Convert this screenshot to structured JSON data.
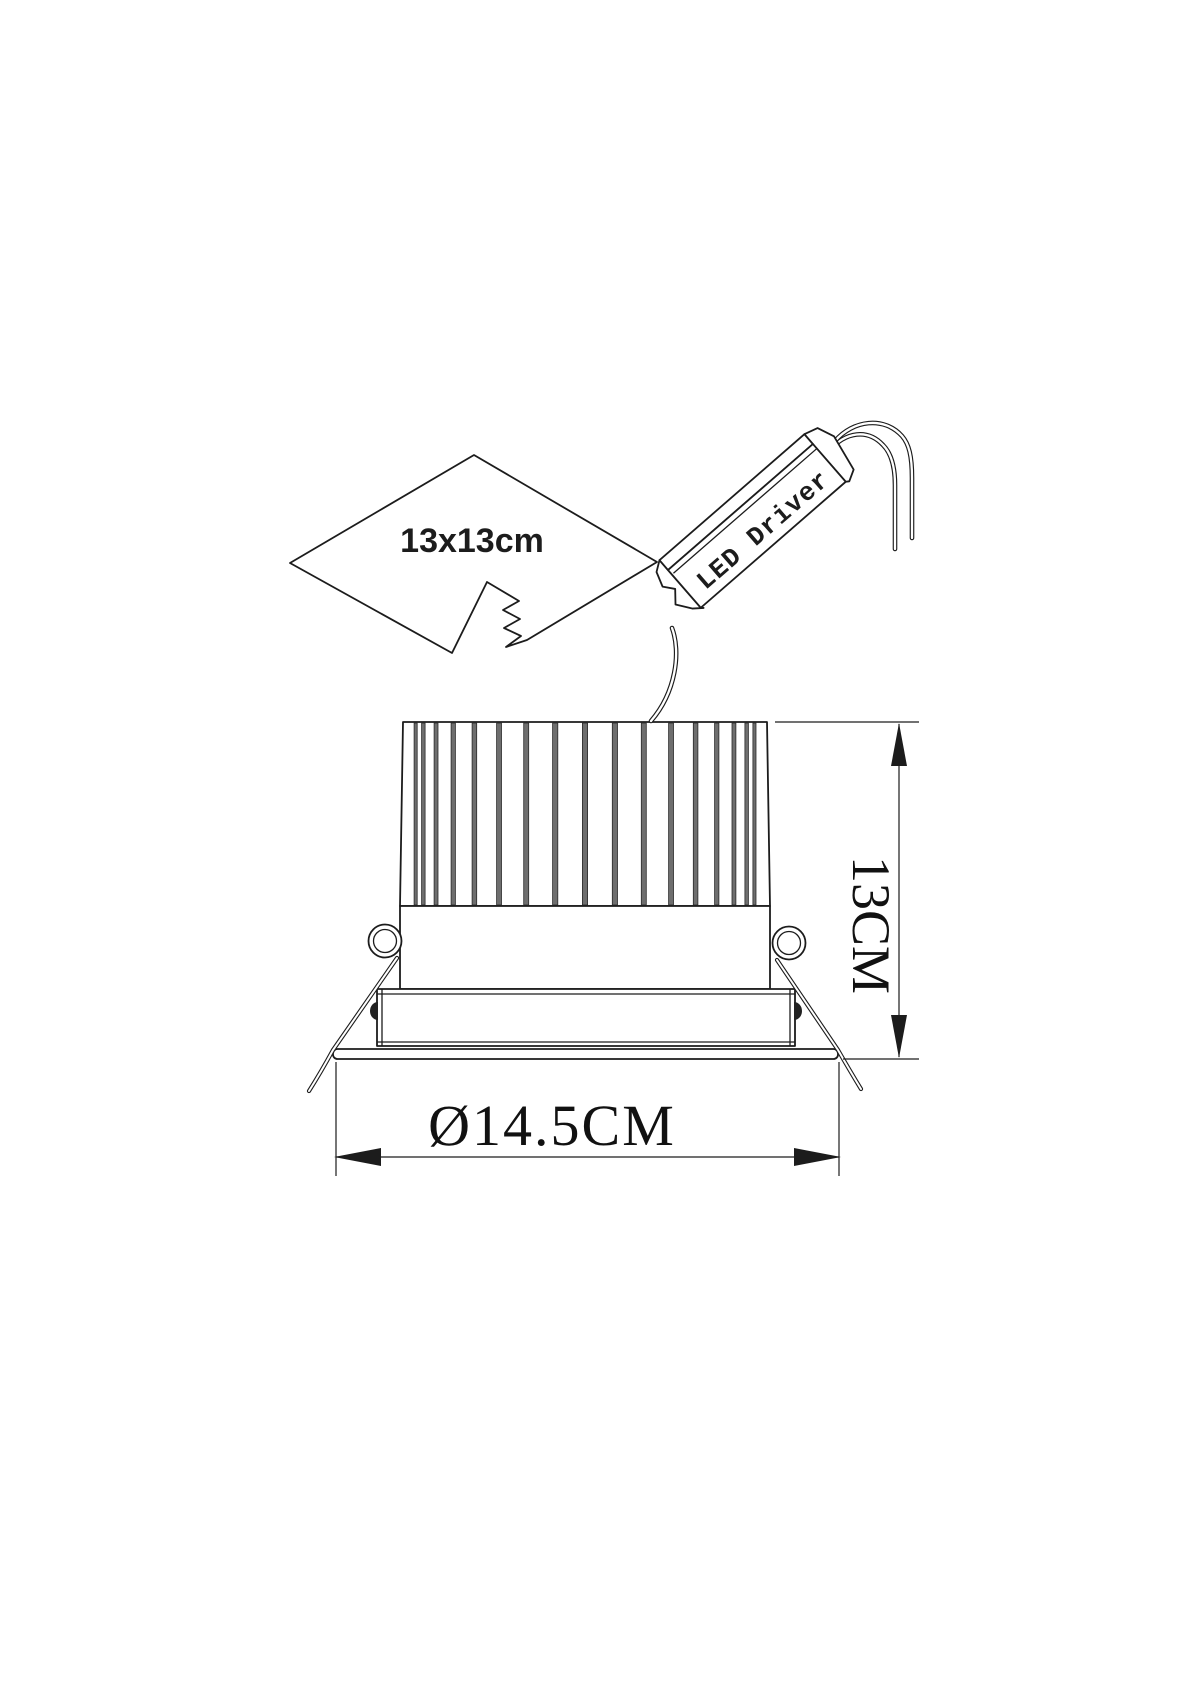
{
  "labels": {
    "cutout": "13x13cm",
    "driver": "LED Driver",
    "height": "13CM",
    "diameter": "Ø14.5CM"
  },
  "heatsink": {
    "fin_count": 17
  },
  "colors": {
    "line": "#1c1c1c",
    "fin": "#6e6e6e",
    "fin_edge": "#2a2a2a",
    "background": "#ffffff"
  }
}
